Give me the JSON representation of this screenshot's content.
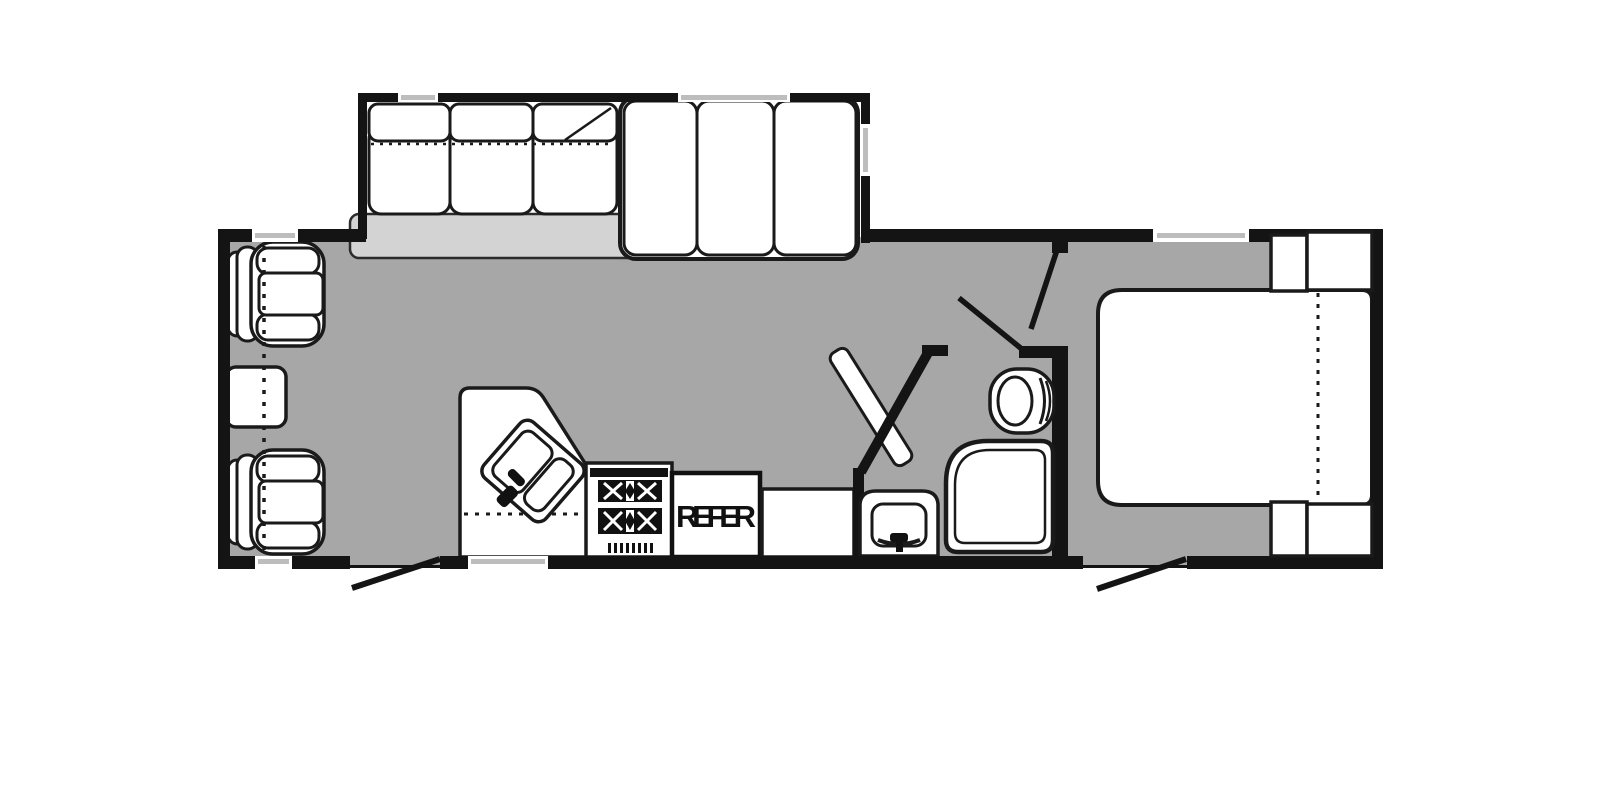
{
  "document": {
    "type": "rv-travel-trailer-floorplan",
    "description": "Black and white RV floor plan with gray floor, top slide-out with sofa and bunk bed, front living area with two recliners and side table, mid kitchen with corner double sink, stove and refrigerator, angled-entry bathroom with toilet, neo-angle shower and vanity sink, rear bedroom with queen bed and corner cabinets, two exterior entry doors"
  },
  "labels": {
    "refrigerator": "REFER"
  },
  "colors": {
    "background": "#ffffff",
    "floor": "#a7a7a7",
    "slide_out_floor": "#d3d3d3",
    "wall": "#141414",
    "fixture_fill": "#ffffff",
    "fixture_outline": "#1a1a1a",
    "window_line": "#bdbdbd"
  },
  "fixtures": [
    "slide-out-box",
    "sofa",
    "fold-line",
    "bunk-bed",
    "recliner-chair",
    "side-table",
    "kitchen-counter",
    "corner-double-sink",
    "faucet",
    "stove",
    "refrigerator",
    "counter",
    "bath-angled-wall",
    "bath-door",
    "toilet",
    "shower",
    "vanity-sink",
    "bedroom-door-swing",
    "bath-door-swing",
    "queen-bed",
    "mattress-fold-line",
    "nightstand-cabinet",
    "entry-door",
    "window",
    "travel-position-dashed-line"
  ]
}
